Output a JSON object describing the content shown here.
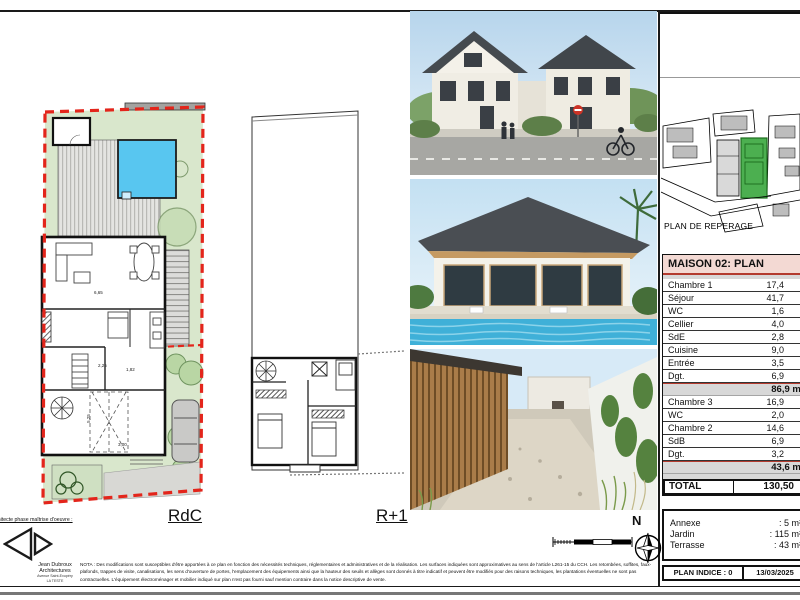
{
  "sheet": {
    "rdc_label": "RdC",
    "r1_label": "R+1",
    "north_label": "N"
  },
  "reperage": {
    "caption": "PLAN DE REPERAGE"
  },
  "area_table": {
    "title": "MAISON 02: PLAN",
    "groups": [
      {
        "rows": [
          {
            "label": "Chambre 1",
            "value": "17,4"
          },
          {
            "label": "Séjour",
            "value": "41,7"
          },
          {
            "label": "WC",
            "value": "1,6"
          },
          {
            "label": "Cellier",
            "value": "4,0"
          },
          {
            "label": "SdE",
            "value": "2,8"
          },
          {
            "label": "Cuisine",
            "value": "9,0"
          },
          {
            "label": "Entrée",
            "value": "3,5"
          },
          {
            "label": "Dgt.",
            "value": "6,9"
          }
        ],
        "subtotal": "86,9 m²"
      },
      {
        "rows": [
          {
            "label": "Chambre 3",
            "value": "16,9"
          },
          {
            "label": "WC",
            "value": "2,0"
          },
          {
            "label": "Chambre 2",
            "value": "14,6"
          },
          {
            "label": "SdB",
            "value": "6,9"
          },
          {
            "label": "Dgt.",
            "value": "3,2"
          }
        ],
        "subtotal": "43,6 m²"
      }
    ],
    "total": {
      "label": "TOTAL",
      "value": "130,50"
    }
  },
  "exterior": {
    "rows": [
      {
        "label": "Annexe",
        "value": ": 5 m²"
      },
      {
        "label": "Jardin",
        "value": ": 115 m²"
      },
      {
        "label": "Terrasse",
        "value": ": 43 m²"
      }
    ]
  },
  "title_block": {
    "indice": "PLAN INDICE : 0",
    "date": "13/03/2025"
  },
  "architect": {
    "phase_note": "Architecte phase maîtrise d'oeuvre :",
    "name_line1": "Jean Dubroux",
    "name_line2": "Architectures",
    "address_line1": "Avenue Saint-Exupéry",
    "address_line2": "LA TESTE"
  },
  "nota": "NOTA : Des modifications sont susceptibles d'être apportées à ce plan en fonction des nécessités techniques, réglementaires et administratives et de la réalisation. Les surfaces indiquées sont approximatives au sens de l'article L261-15 du CCH. Les retombées, soffites, faux-plafonds, trappes de visite, canalisations, les sens d'ouverture de portes, l'emplacement des équipements ainsi que la hauteur des seuils et allèges sont donnés à titre indicatif et peuvent être modifiés pour des raisons techniques, les plantations éventuelles ne sont pas contractuelles. L'équipement électroménager et mobilier indiqué sur plan n'est pas fourni sauf mention contraire dans la notice descriptive de vente.",
  "plan_dims": [
    {
      "text": "6,65",
      "left": 94,
      "top": 290,
      "rot": 0
    },
    {
      "text": "2,25",
      "left": 98,
      "top": 363,
      "rot": 0
    },
    {
      "text": "1,82",
      "left": 126,
      "top": 367,
      "rot": 0
    },
    {
      "text": "3,00",
      "left": 118,
      "top": 442,
      "rot": 0
    },
    {
      "text": "5,25",
      "left": 84,
      "top": 416,
      "rot": -90
    }
  ],
  "colors": {
    "boundary_red": "#e3251b",
    "garden_green": "#d9e7cc",
    "pool_blue": "#58c6f0",
    "table_header_pink": "#f3d9d3",
    "accent_red": "#b33a2e",
    "reperage_green": "#4caf50"
  }
}
